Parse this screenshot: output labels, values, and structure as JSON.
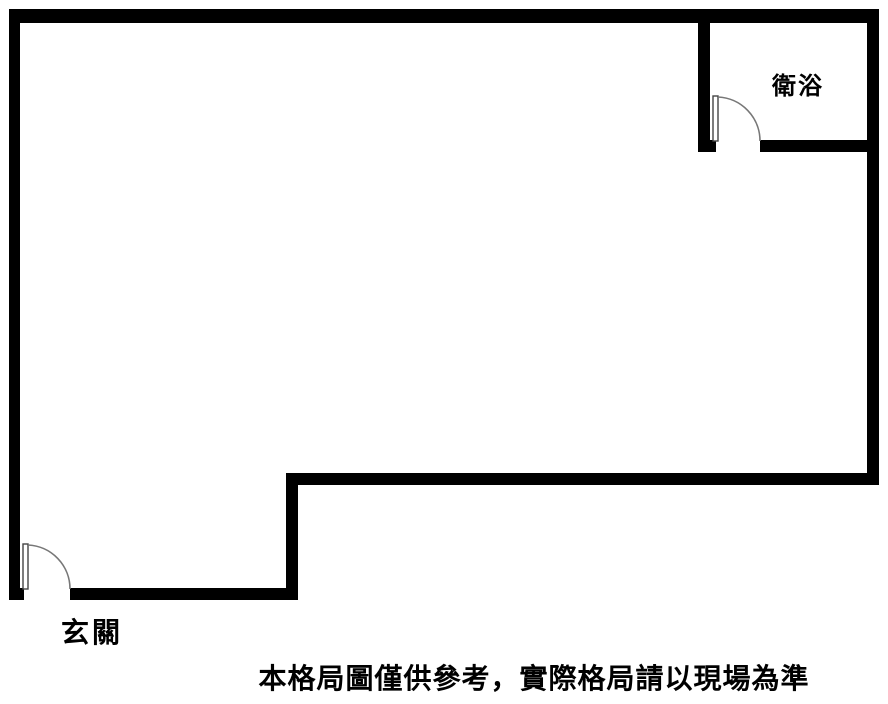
{
  "floor_plan": {
    "background_color": "#ffffff",
    "wall_color": "#000000",
    "door_arc_color": "#777777",
    "labels": {
      "bathroom": "衛浴",
      "entrance": "玄關"
    },
    "disclaimer": "本格局圖僅供參考，實際格局請以現場為準"
  }
}
